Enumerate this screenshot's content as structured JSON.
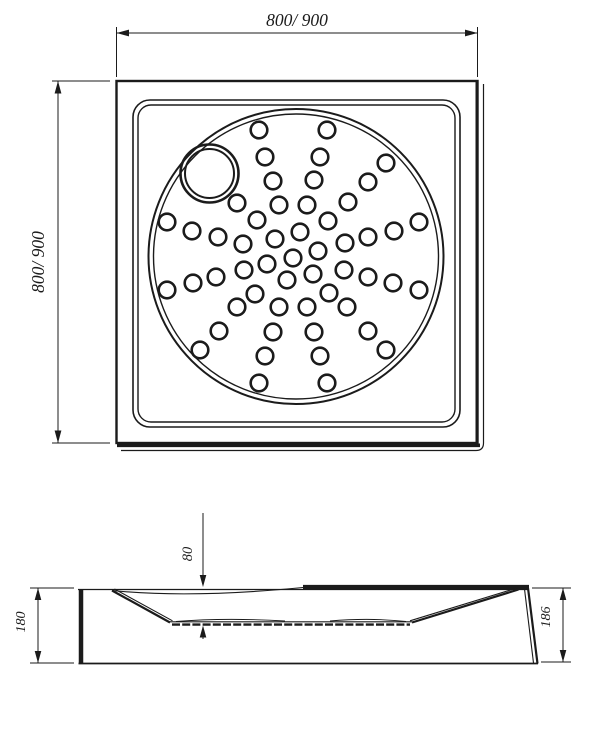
{
  "drawing": {
    "colors": {
      "line": "#1b1b1b",
      "background": "#ffffff"
    },
    "top_view": {
      "width_label": "800/ 900",
      "height_label": "800/ 900",
      "hole_radius": 8.3,
      "outer_circle": {
        "cx": 296,
        "cy": 256.5,
        "r": 147.5,
        "inner_r": 142.5
      },
      "drain_circle": {
        "cx": 209.5,
        "cy": 173.5,
        "r": 29,
        "inner_r": 24.5
      },
      "holes": [
        [
          259,
          130
        ],
        [
          327,
          130
        ],
        [
          265,
          157
        ],
        [
          320,
          157
        ],
        [
          273,
          181
        ],
        [
          314,
          180
        ],
        [
          386,
          163
        ],
        [
          368,
          182
        ],
        [
          348,
          202
        ],
        [
          237,
          203
        ],
        [
          279,
          205
        ],
        [
          307,
          205
        ],
        [
          257,
          220
        ],
        [
          328,
          221
        ],
        [
          300,
          232
        ],
        [
          275,
          239
        ],
        [
          243,
          244
        ],
        [
          345,
          243
        ],
        [
          318,
          251
        ],
        [
          293,
          258
        ],
        [
          267,
          264
        ],
        [
          344,
          270
        ],
        [
          244,
          270
        ],
        [
          313,
          274
        ],
        [
          287,
          280
        ],
        [
          255,
          294
        ],
        [
          329,
          293
        ],
        [
          237,
          307
        ],
        [
          279,
          307
        ],
        [
          307,
          307
        ],
        [
          347,
          307
        ],
        [
          167,
          222
        ],
        [
          192,
          231
        ],
        [
          218,
          237
        ],
        [
          216,
          277
        ],
        [
          193,
          283
        ],
        [
          167,
          290
        ],
        [
          419,
          222
        ],
        [
          394,
          231
        ],
        [
          368,
          237
        ],
        [
          368,
          277
        ],
        [
          393,
          283
        ],
        [
          419,
          290
        ],
        [
          273,
          332
        ],
        [
          314,
          332
        ],
        [
          265,
          356
        ],
        [
          320,
          356
        ],
        [
          259,
          383
        ],
        [
          327,
          383
        ],
        [
          219,
          331
        ],
        [
          200,
          350
        ],
        [
          368,
          331
        ],
        [
          386,
          350
        ]
      ]
    },
    "side_view": {
      "depth_label": "80",
      "left_height_label": "180",
      "right_height_label": "186"
    }
  }
}
